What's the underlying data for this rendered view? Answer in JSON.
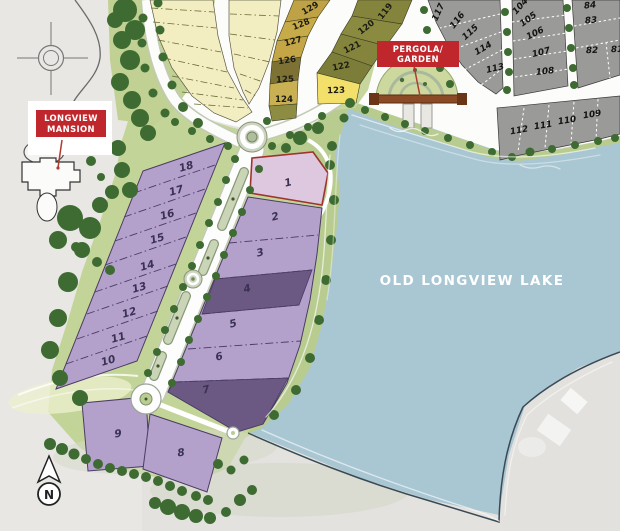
{
  "labels": {
    "mansion_line1": "LONGVIEW",
    "mansion_line2": "MANSION",
    "pergola_line1": "PERGOLA/",
    "pergola_line2": "GARDEN",
    "lake": "OLD LONGVIEW LAKE",
    "compass": "N"
  },
  "lots": {
    "purple_west": [
      "18",
      "17",
      "16",
      "15",
      "14",
      "13",
      "12",
      "11",
      "10"
    ],
    "purple_east": [
      "1",
      "2",
      "3",
      "4",
      "5",
      "6",
      "7"
    ],
    "purple_south": [
      "9",
      "8"
    ],
    "gold_arc": [
      "129",
      "128",
      "127",
      "126",
      "125",
      "124"
    ],
    "olive_arc": [
      "119",
      "120",
      "121",
      "122",
      "123"
    ],
    "gray_fan_a": [
      "117",
      "116",
      "115",
      "114",
      "113"
    ],
    "gray_fan_b": [
      "104",
      "105",
      "106",
      "107",
      "108"
    ],
    "gray_fan_c": [
      "84",
      "83",
      "82",
      "81"
    ],
    "gray_shore_row": [
      "112",
      "111",
      "110",
      "109"
    ]
  },
  "colors": {
    "accent_red": "#c0272d",
    "lake_blue": "#a9c6d3",
    "purple": "#b3a0cb",
    "purple_dark": "#6b5983",
    "lot1_highlight": "#ddc8df",
    "lot1_border": "#a0342c",
    "pale_yellow": "#f3edc2",
    "gold": "#c8ab49",
    "olive": "#84843d",
    "yellow_highlight": "#f2e06b",
    "gray_lot": "#9a9a98",
    "green_light": "#c3d498",
    "tree_green": "#3e6b32"
  }
}
